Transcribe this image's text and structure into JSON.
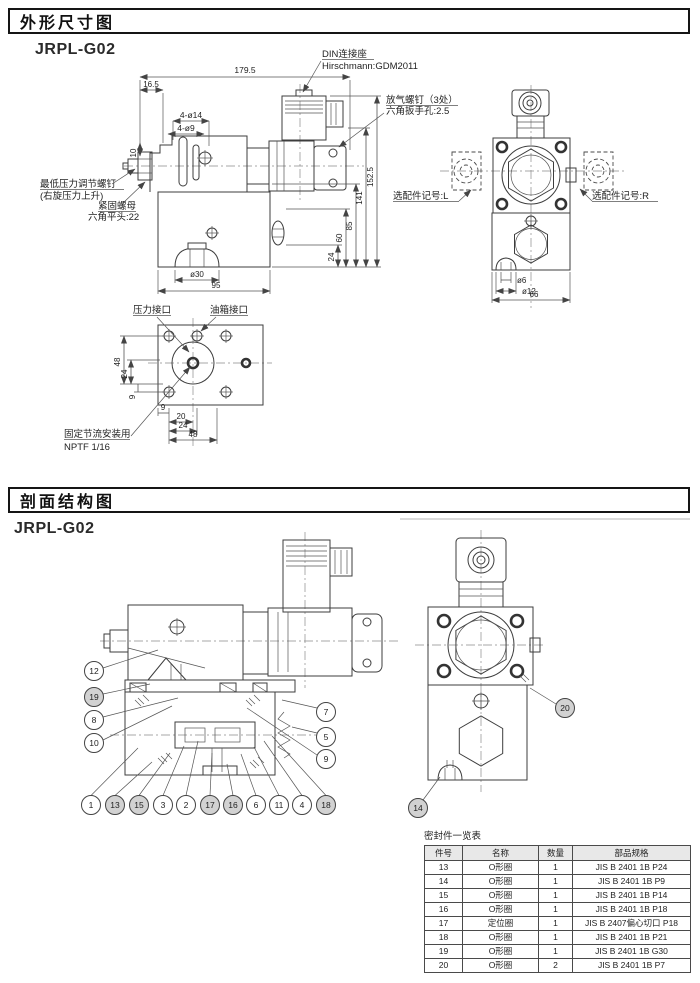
{
  "section1": {
    "header": "外形尺寸图",
    "model": "JRPL-G02",
    "labels": {
      "din_connector": "DIN连接座",
      "din_model": "Hirschmann:GDM2011",
      "bleed_screw": "放气螺钉（3处）",
      "bleed_hex": "六角扳手孔:2.5",
      "min_pressure_screw": "最低压力调节螺钉",
      "min_pressure_note": "(右旋压力上升)",
      "lock_nut": "紧固螺母",
      "lock_nut_hex": "六角平头:22",
      "option_l": "选配件记号:L",
      "option_r": "选配件记号:R",
      "pressure_port": "压力接口",
      "tank_port": "油箱接口",
      "throttle_mount": "固定节流安装用",
      "throttle_thread": "NPTF 1/16"
    },
    "dims": {
      "overall_width": "179.5",
      "top_offset": "16.5",
      "holes_large": "4-ø14",
      "holes_small": "4-ø9",
      "step10": "10",
      "h1525": "152.5",
      "h141": "141",
      "h85": "85",
      "h60": "60",
      "h24": "24",
      "boss30": "ø30",
      "base95": "95",
      "side66": "66",
      "boss6": "ø6",
      "boss12": "ø12",
      "fl48": "48",
      "fl24": "24",
      "fl9": "9",
      "fb9": "9",
      "fb20": "20",
      "fb24": "24",
      "fb48": "48"
    }
  },
  "section2": {
    "header": "剖面结构图",
    "model": "JRPL-G02",
    "balloons_left": [
      "12",
      "19",
      "8",
      "10"
    ],
    "balloons_right": [
      "7",
      "5",
      "9"
    ],
    "balloons_bottom": [
      "1",
      "13",
      "15",
      "3",
      "2",
      "17",
      "16",
      "6",
      "11",
      "4",
      "18"
    ],
    "balloon_rv_top": "20",
    "balloon_rv_bottom": "14"
  },
  "seal_table": {
    "title": "密封件一览表",
    "headers": [
      "件号",
      "名称",
      "数量",
      "部品规格"
    ],
    "rows": [
      [
        "13",
        "O形圈",
        "1",
        "JIS B 2401 1B P24"
      ],
      [
        "14",
        "O形圈",
        "1",
        "JIS B 2401 1B P9"
      ],
      [
        "15",
        "O形圈",
        "1",
        "JIS B 2401 1B P14"
      ],
      [
        "16",
        "O形圈",
        "1",
        "JIS B 2401 1B P18"
      ],
      [
        "17",
        "定位圈",
        "1",
        "JIS B 2407偏心切口 P18"
      ],
      [
        "18",
        "O形圈",
        "1",
        "JIS B 2401 1B P21"
      ],
      [
        "19",
        "O形圈",
        "1",
        "JIS B 2401 1B G30"
      ],
      [
        "20",
        "O形圈",
        "2",
        "JIS B 2401 1B P7"
      ]
    ]
  }
}
